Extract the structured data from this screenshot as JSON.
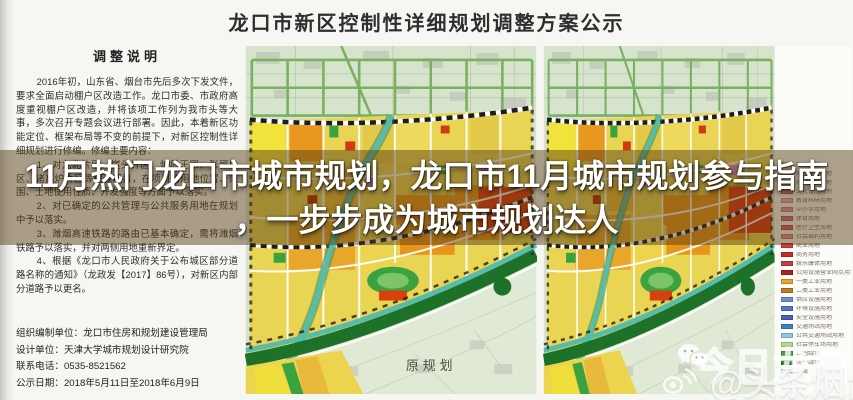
{
  "page": {
    "title": "龙口市新区控制性详细规划调整方案公示"
  },
  "notice_panel": {
    "heading": "调整说明",
    "intro": "2016年初，山东省、烟台市先后多次下发文件，要求全面启动棚户区改造工作。龙口市委、市政府高度重视棚户区改造，并将该项工作列为我市头等大事，多次召开专题会议进行部署。因此，本着新区功能定位、框架布局等不变的前提下，对新区控制性详细规划进行修编。修编主要内容：",
    "items": [
      "1、对九北片区、崖头片区、炉后王家、张郭片区、诸高炉片区等棚改项目，在项目的用地位置、范围、土地使用性质、开发强度等方面予以落实。",
      "2、对已确定的公共管理与公共服务用地在规划中予以落实。",
      "3、潍烟高速铁路的路由已基本确定，需将潍烟铁路予以落实，并对两侧用地重新界定。",
      "4、根据《龙口市人民政府关于公布城区部分道路名称的通知》（龙政发【2017】86号），对新区内部分道路予以更名。"
    ],
    "footer": {
      "organizer": "组织编制单位：龙口市住房和规划建设管理局",
      "designer": "设计单位：天津大学城市规划设计研究院",
      "phone": "联系电话：0535-8521562",
      "period": "公示日期：2018年5月11日至2018年6月9日"
    }
  },
  "maps": {
    "original_label": "原规划",
    "legend": {
      "items": [
        {
          "color": "#f2e14e",
          "label": "居住用地"
        },
        {
          "color": "#f0c060",
          "label": "商住混合用地"
        },
        {
          "color": "#e89aa6",
          "label": "行政办公用地"
        },
        {
          "color": "#e8808e",
          "label": "文化设施用地"
        },
        {
          "color": "#f0a8b4",
          "label": "教育科研用地"
        },
        {
          "color": "#e89098",
          "label": "中小学用地"
        },
        {
          "color": "#d86878",
          "label": "体育用地"
        },
        {
          "color": "#e05868",
          "label": "医疗卫生用地"
        },
        {
          "color": "#e88a9a",
          "label": "社会福利用地"
        },
        {
          "color": "#da3e36",
          "label": "商业用地"
        },
        {
          "color": "#c42e2a",
          "label": "商务用地"
        },
        {
          "color": "#b84048",
          "label": "娱乐康体用地"
        },
        {
          "color": "#a82420",
          "label": "公用设施营业网点用地"
        },
        {
          "color": "#f09e2e",
          "label": "一类工业用地"
        },
        {
          "color": "#c27a1e",
          "label": "二类工业用地"
        },
        {
          "color": "#6e8ed6",
          "label": "供应设施用地"
        },
        {
          "color": "#5876c6",
          "label": "环境设施用地"
        },
        {
          "color": "#4462b6",
          "label": "安全设施用地"
        },
        {
          "color": "#3c80c4",
          "label": "交通场站用地"
        },
        {
          "color": "#8ec6e6",
          "label": "公共交通场站用地"
        },
        {
          "color": "#b6d88e",
          "label": "社会停车场用地"
        },
        {
          "color": "#3aa83e",
          "label": "公园绿地"
        },
        {
          "color": "#1e7e2e",
          "label": "防护绿地"
        },
        {
          "color": "#74c2da",
          "label": "水域"
        }
      ]
    }
  },
  "banner": {
    "line1": "11月热门龙口市城市规划，龙口市11月城市规划参与指南",
    "line2": "，一步步成为城市规划达人",
    "text_color": "#ffffff"
  },
  "watermark": {
    "brand": "今日龙口",
    "handle": "@头条烟台"
  }
}
